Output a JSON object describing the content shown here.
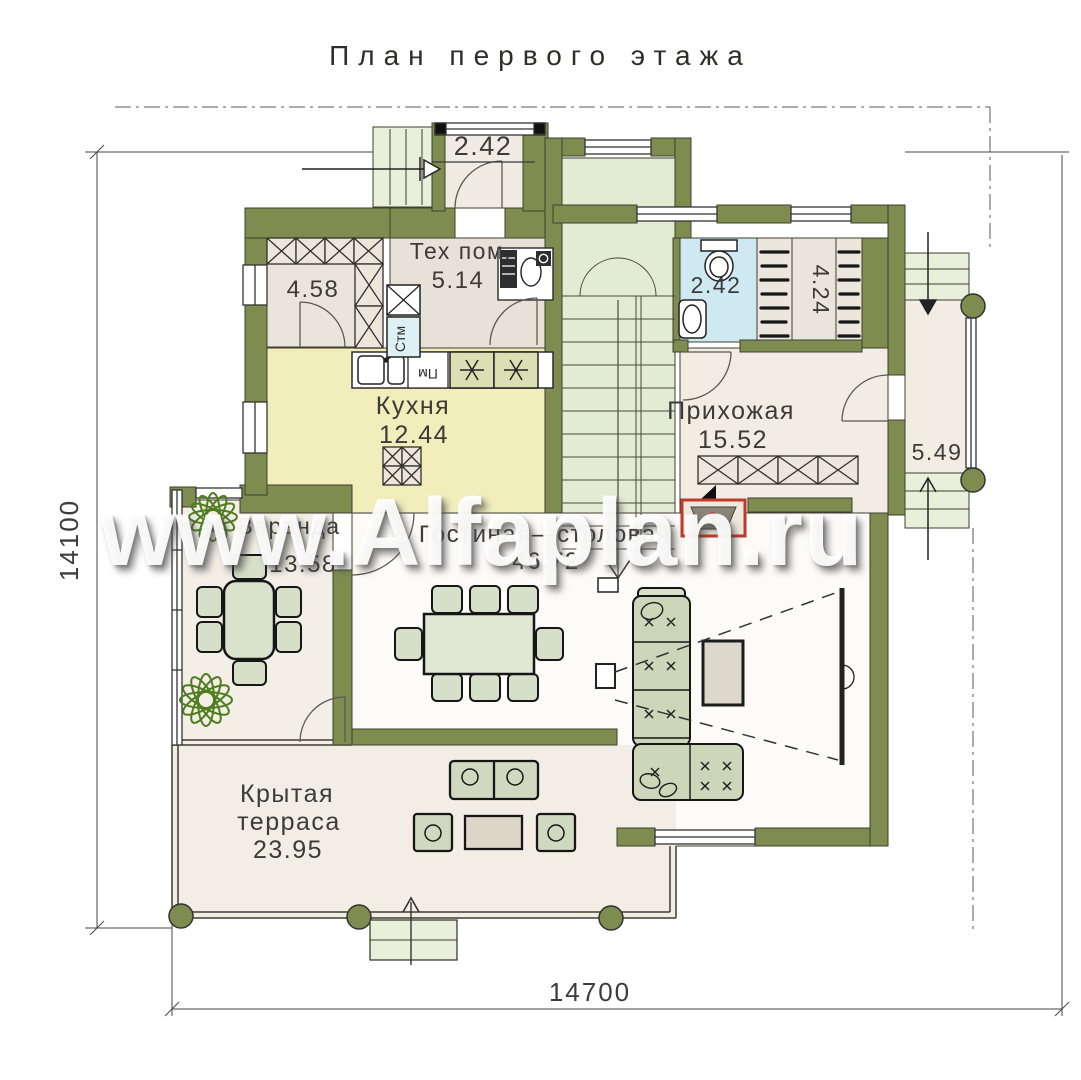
{
  "title": "План первого этажа",
  "watermark": "www.Alfaplan.ru",
  "dimensions": {
    "left": "14100",
    "bottom": "14700"
  },
  "rooms": {
    "tambour": {
      "area": "2.42"
    },
    "storage": {
      "area": "4.58"
    },
    "tech": {
      "name": "Тех пом.",
      "area": "5.14"
    },
    "kitchen": {
      "name": "Кухня",
      "area": "12.44"
    },
    "bathroom": {
      "area": "2.42"
    },
    "wardrobe": {
      "area": "4.24"
    },
    "hallway": {
      "name": "Прихожая",
      "area": "15.52"
    },
    "porch": {
      "area": "5.49"
    },
    "veranda": {
      "name": "Веранда",
      "area": "13.58"
    },
    "living": {
      "name": "Гостиная—столовая",
      "area": "46.72"
    },
    "terrace": {
      "name_line1": "Крытая",
      "name_line2": "терраса",
      "area": "23.95"
    }
  },
  "appliances": {
    "washer": "Стм",
    "dishwasher": "Пм"
  },
  "colors": {
    "wall": "#7e8c50",
    "stairs": "#e2ecd2",
    "kitchen_floor": "#f1eebc",
    "bath_floor": "#cfe9f2",
    "cream_floor": "#f2ece3",
    "fireplace_red": "#c03a2b"
  }
}
